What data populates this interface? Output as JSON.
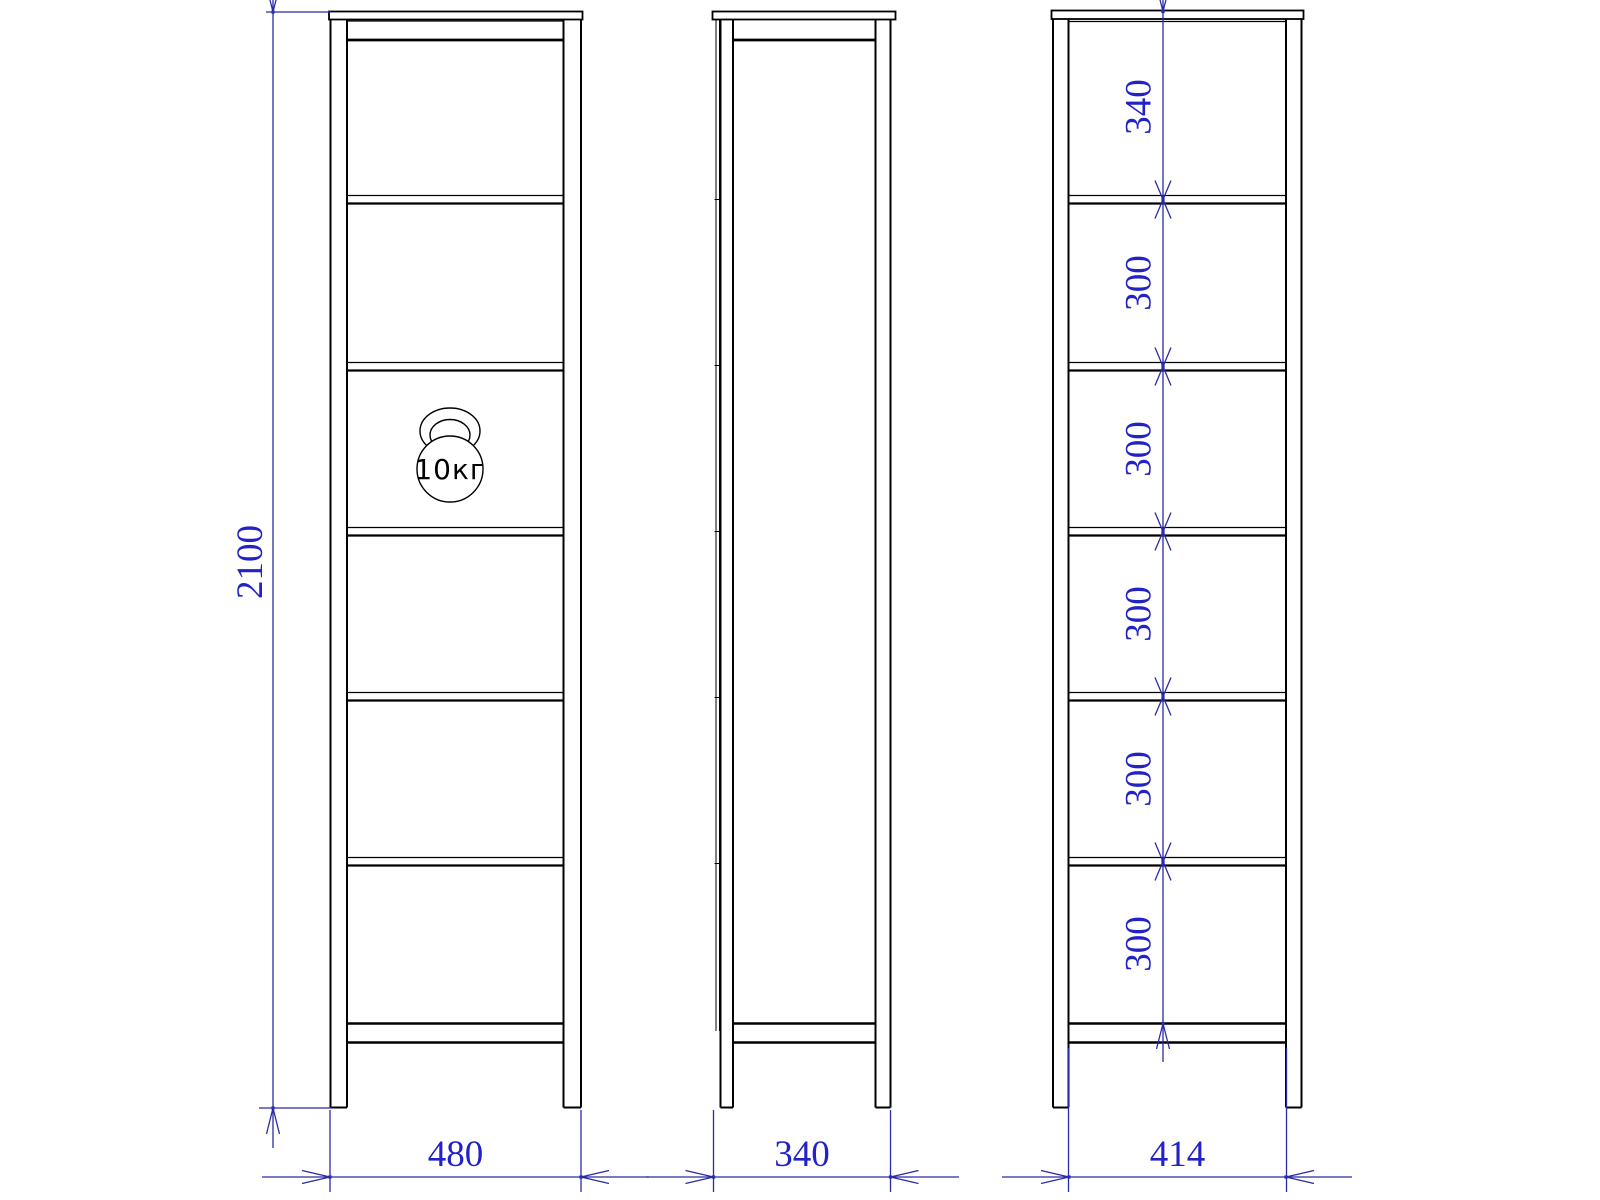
{
  "views": {
    "front": {
      "height_label": "2100",
      "width_label": "480",
      "load_badge": "10кг"
    },
    "side": {
      "width_label": "340"
    },
    "spacing": {
      "width_label": "414",
      "shelf_spacings": [
        "340",
        "300",
        "300",
        "300",
        "300",
        "300"
      ]
    }
  },
  "colors": {
    "dimension_blue": "#2222c6",
    "outline_black": "#000000"
  }
}
